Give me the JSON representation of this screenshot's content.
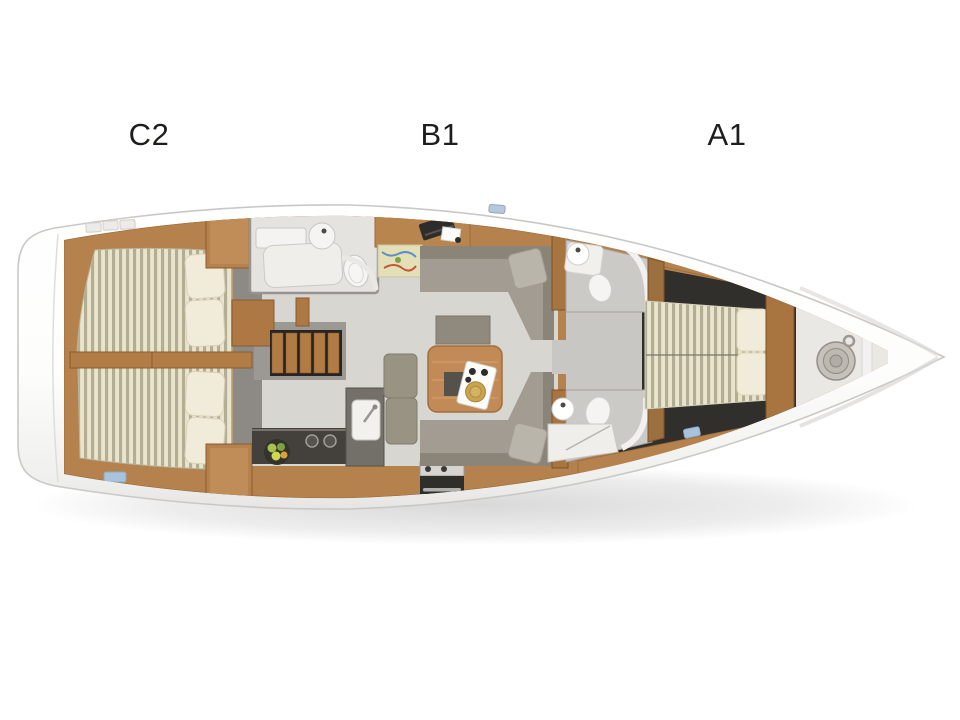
{
  "plan": {
    "section_labels": [
      {
        "label": "C2",
        "area": "aft-cabin"
      },
      {
        "label": "B1",
        "area": "salon"
      },
      {
        "label": "A1",
        "area": "forward-cabin"
      }
    ],
    "colors": {
      "background": "#ffffff",
      "hull_white": "#fdfdfc",
      "hull_outline": "#c9c8c6",
      "wood": "#b5814d",
      "wood_dark": "#8a5c2c",
      "floor_light": "#d8d6d1",
      "floor_gray": "#9c9994",
      "floor_dark": "#302f2c",
      "sofa_gray": "#a29c92",
      "sofa_back": "#8b8478",
      "mattress_cream": "#e9e4cd",
      "mattress_stripe": "#b2ae94",
      "pillow": "#f1ecd9",
      "counter_dark": "#44413d",
      "fixture_white": "#f2f1ee",
      "hatch_blue": "#a9c3dd",
      "table_wood": "#c18a56",
      "tray_plate_gold": "#c9a34d"
    }
  }
}
